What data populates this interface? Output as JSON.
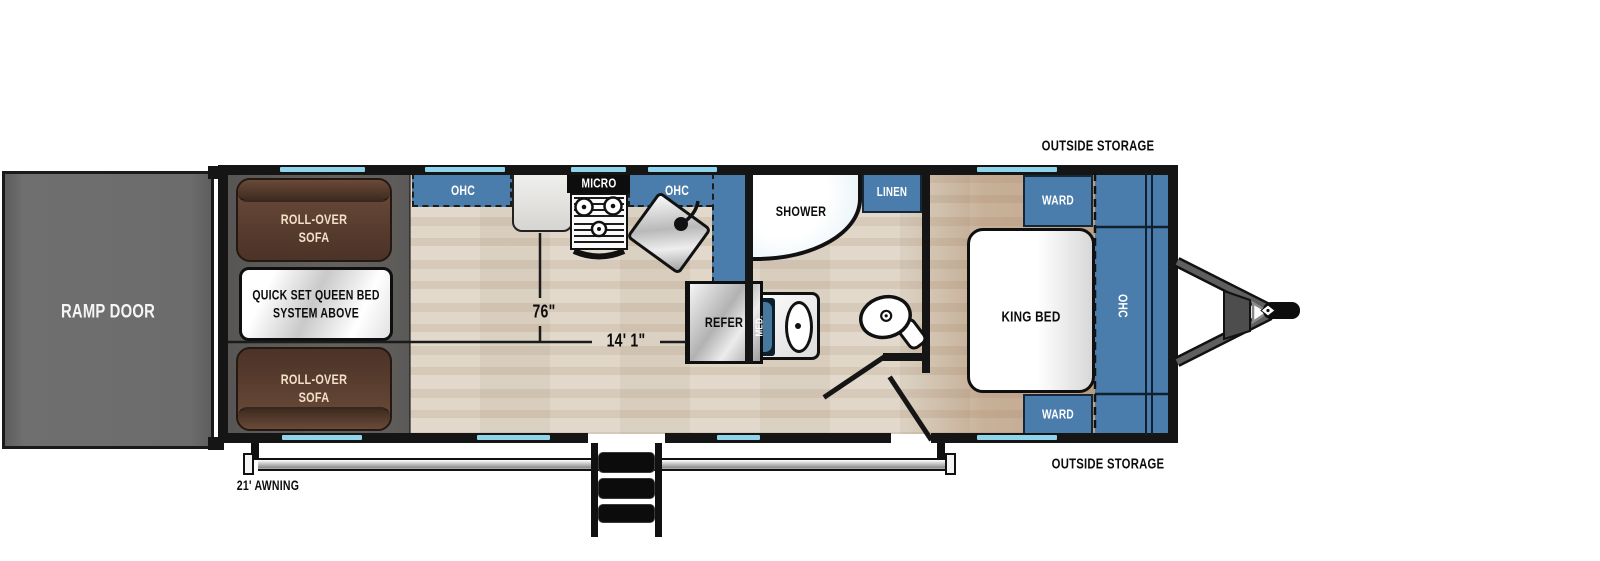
{
  "floorplan": {
    "exterior": {
      "ramp_door": "RAMP DOOR",
      "awning": "21' AWNING",
      "outside_storage_top": "OUTSIDE STORAGE",
      "outside_storage_bottom": "OUTSIDE STORAGE"
    },
    "garage": {
      "sofa_top": "ROLL-OVER\nSOFA",
      "sofa_bottom": "ROLL-OVER\nSOFA",
      "queen_bed": "QUICK SET QUEEN BED\nSYSTEM ABOVE"
    },
    "kitchen": {
      "ohc_left": "OHC",
      "micro": "MICRO",
      "ohc_right": "OHC",
      "refer": "REFER"
    },
    "bathroom": {
      "shower": "SHOWER",
      "linen": "LINEN",
      "med": "MED."
    },
    "bedroom": {
      "king_bed": "KING BED",
      "ward_top": "WARD",
      "ward_bottom": "WARD",
      "ohc": "OHC"
    },
    "dimensions": {
      "garage_width": "76\"",
      "garage_length": "14' 1\""
    }
  },
  "colors": {
    "cabinet_blue": "#4a7dab",
    "window_blue": "#8fd4ea",
    "wall_black": "#151515",
    "sofa_brown": "#5d4234",
    "floor_wood": "#dfd5c6",
    "garage_gray": "#5f5d5b",
    "ramp_gray": "#6c6c6c"
  }
}
